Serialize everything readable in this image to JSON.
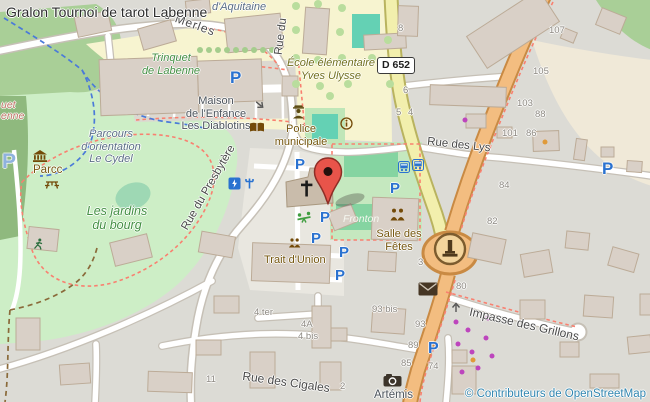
{
  "map": {
    "title": "Gralon Tournoi de tarot Labenne",
    "attribution": "© Contributeurs de OpenStreetMap",
    "road_shield": "D 652",
    "streets": {
      "merles": "s Merles",
      "rue_du": "Rue du",
      "presbytere": "Rue du Presbytère",
      "lys": "Rue des Lys",
      "cigales": "Rue des Cigales",
      "grillons": "Impasse des Grillons"
    },
    "labels": {
      "aquitaine": "d'Aquitaine",
      "trinquet_1": "Trinquet",
      "trinquet_2": "de Labenne",
      "maison_1": "Maison",
      "maison_2": "de l'Enfance",
      "maison_3": "Les Diablotins",
      "ecole_1": "École élémentaire",
      "ecole_2": "Yves Ulysse",
      "police_1": "Police",
      "police_2": "municipale",
      "parcours_1": "Parcours",
      "parcours_2": "d'orientation",
      "parcours_3": "Le Cydel",
      "parcc": "Parcc",
      "jardins_1": "Les jardins",
      "jardins_2": "du bourg",
      "fronton": "Fronton",
      "salle_1": "Salle des",
      "salle_2": "Fêtes",
      "trait": "Trait d'Union",
      "artemis": "Artémis",
      "fragment_1": "uet",
      "fragment_2": "enne"
    },
    "house_numbers": [
      "8",
      "6",
      "5",
      "4",
      "105",
      "107",
      "103",
      "101",
      "88",
      "86",
      "84",
      "82",
      "80",
      "3",
      "93",
      "89",
      "85",
      "74",
      "93 bis",
      "4 ter",
      "4A",
      "4 bis",
      "11",
      "2"
    ],
    "icons": {
      "parking_letter": "P",
      "glyphs": [
        "marker-pin-icon",
        "parking-icon",
        "bus-stop-icon",
        "police-officer-icon",
        "library-book-icon",
        "info-icon",
        "museum-icon",
        "picnic-table-icon",
        "church-cross-icon",
        "playground-icon",
        "charging-station-icon",
        "drinking-water-icon",
        "monument-icon",
        "post-box-icon",
        "camera-icon",
        "community-people-icon",
        "runner-icon",
        "oneway-arrow-icon"
      ]
    },
    "colors": {
      "primary_road": "#f3bd80",
      "secondary_road": "#f2efad",
      "park_green": "#cdeec6",
      "forest_green": "#a9cf97",
      "pitch_teal": "#64d1b4",
      "court_green": "#85d4a1",
      "school_yellow": "#f7f4d0",
      "building": "#d9d0c7",
      "residential": "#dcdbd5",
      "sand_beige": "#f0e9d8",
      "parking_blue": "#2a72d0",
      "marker_red": "#e8544a",
      "poi_brown": "#75560e",
      "leisure_label_green": "#449044",
      "attribution_blue": "#3186b0"
    }
  }
}
